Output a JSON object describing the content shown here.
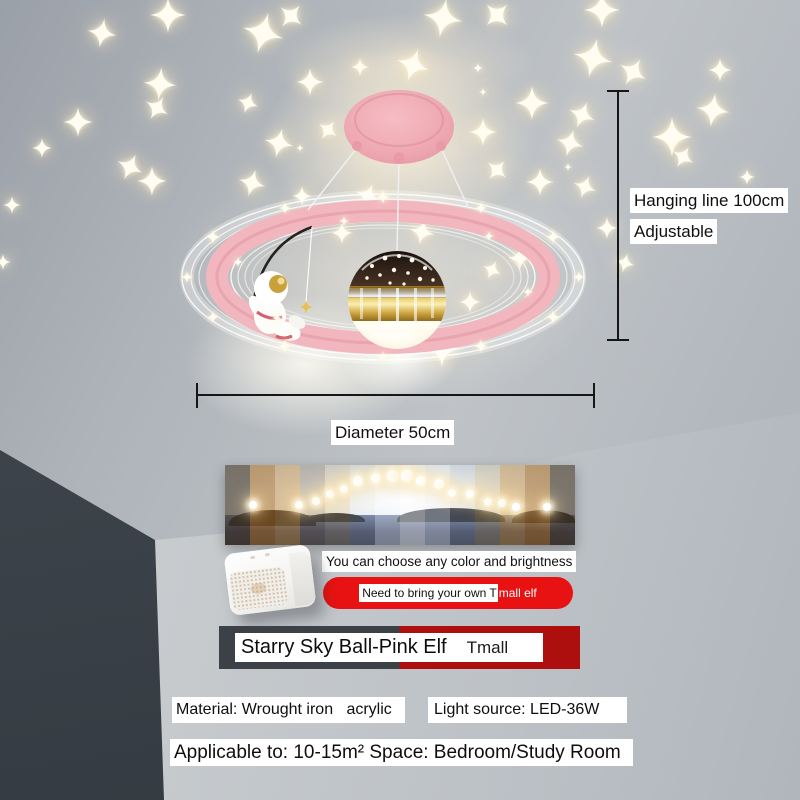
{
  "annotations": {
    "hanging_line": "Hanging line 100cm",
    "adjustable": "Adjustable",
    "diameter": "Diameter 50cm"
  },
  "banner": {
    "caption": "You can choose any color and brightness",
    "stripe_colors": [
      "rgba(80,62,38,0.60)",
      "rgba(186,115,28,0.52)",
      "rgba(224,158,62,0.44)",
      "rgba(160,130,88,0.34)",
      "rgba(232,196,128,0.28)",
      "rgba(242,238,228,0.22)",
      "rgba(250,252,255,0.40)",
      "rgba(255,255,255,0.50)",
      "rgba(250,252,255,0.40)",
      "rgba(238,236,228,0.22)",
      "rgba(234,198,126,0.30)",
      "rgba(224,158,62,0.44)",
      "rgba(186,115,28,0.52)",
      "rgba(80,62,38,0.60)"
    ],
    "islands": [
      [
        1,
        26,
        16,
        56
      ],
      [
        23,
        40,
        9,
        60
      ],
      [
        49,
        80,
        14,
        54
      ],
      [
        82,
        100,
        13,
        56
      ]
    ],
    "dots": [
      [
        8,
        50,
        4
      ],
      [
        21,
        50,
        4
      ],
      [
        26,
        45,
        4
      ],
      [
        30,
        36,
        4
      ],
      [
        34,
        30,
        4
      ],
      [
        38,
        20,
        5
      ],
      [
        43,
        16,
        5
      ],
      [
        48,
        14,
        6
      ],
      [
        52,
        14,
        6
      ],
      [
        56,
        20,
        5
      ],
      [
        61,
        24,
        5
      ],
      [
        65,
        35,
        4
      ],
      [
        70,
        36,
        4
      ],
      [
        75,
        46,
        4
      ],
      [
        79,
        48,
        4
      ],
      [
        83,
        53,
        4
      ],
      [
        92,
        52,
        4
      ]
    ]
  },
  "elf_note": {
    "black_part": "Need to bring your own T",
    "white_part": "mall elf"
  },
  "title": {
    "name": "Starry Sky Ball-Pink Elf",
    "brand": "Tmall"
  },
  "specs": {
    "material": "Material: Wrought iron   acrylic",
    "light_source": "Light source: LED-36W",
    "applicable": "Applicable to: 10-15m² Space: Bedroom/Study Room"
  },
  "colors": {
    "ring_pink": "#f2b6bf",
    "canopy_pink": "#eda6b0",
    "pill_red": "#e81212",
    "bar_red": "#ad0e0e",
    "bar_dark": "#3b4147",
    "gold": "#d9b54a"
  },
  "stars": {
    "ceiling": [
      [
        102,
        33,
        30,
        10
      ],
      [
        168,
        15,
        36,
        0
      ],
      [
        263,
        33,
        42,
        15
      ],
      [
        291,
        16,
        28,
        40
      ],
      [
        160,
        84,
        34,
        5
      ],
      [
        157,
        108,
        26,
        30
      ],
      [
        78,
        122,
        30,
        0
      ],
      [
        248,
        103,
        22,
        20
      ],
      [
        310,
        82,
        28,
        0
      ],
      [
        279,
        143,
        30,
        12
      ],
      [
        42,
        148,
        20,
        0
      ],
      [
        130,
        167,
        28,
        25
      ],
      [
        152,
        181,
        30,
        0
      ],
      [
        252,
        183,
        28,
        15
      ],
      [
        328,
        130,
        22,
        35
      ],
      [
        360,
        67,
        18,
        0
      ],
      [
        12,
        205,
        18,
        0
      ],
      [
        3,
        262,
        16,
        0
      ],
      [
        443,
        18,
        40,
        10
      ],
      [
        497,
        15,
        30,
        45
      ],
      [
        602,
        10,
        36,
        0
      ],
      [
        593,
        58,
        40,
        12
      ],
      [
        633,
        72,
        30,
        30
      ],
      [
        720,
        70,
        24,
        0
      ],
      [
        413,
        65,
        34,
        18
      ],
      [
        532,
        103,
        34,
        0
      ],
      [
        582,
        115,
        28,
        22
      ],
      [
        713,
        110,
        34,
        8
      ],
      [
        672,
        137,
        40,
        0
      ],
      [
        683,
        157,
        24,
        30
      ],
      [
        483,
        132,
        28,
        0
      ],
      [
        570,
        143,
        28,
        15
      ],
      [
        497,
        170,
        24,
        40
      ],
      [
        540,
        182,
        28,
        0
      ],
      [
        585,
        187,
        24,
        20
      ],
      [
        747,
        177,
        16,
        0
      ],
      [
        607,
        228,
        22,
        0
      ],
      [
        625,
        263,
        20,
        15
      ],
      [
        422,
        232,
        26,
        12
      ],
      [
        520,
        258,
        24,
        0
      ],
      [
        492,
        270,
        20,
        25
      ],
      [
        470,
        302,
        22,
        0
      ],
      [
        530,
        307,
        20,
        15
      ],
      [
        342,
        233,
        22,
        0
      ],
      [
        368,
        196,
        26,
        20
      ],
      [
        302,
        196,
        20,
        0
      ],
      [
        442,
        349,
        36,
        0
      ],
      [
        478,
        68,
        10,
        0
      ],
      [
        483,
        92,
        8,
        0
      ],
      [
        568,
        167,
        8,
        0
      ],
      [
        300,
        148,
        8,
        0
      ]
    ],
    "ring": [
      [
        579,
        277,
        12
      ],
      [
        553,
        317,
        14
      ],
      [
        481,
        346,
        14
      ],
      [
        383,
        357,
        12
      ],
      [
        285,
        346,
        14
      ],
      [
        213,
        317,
        12
      ],
      [
        187,
        277,
        12
      ],
      [
        213,
        237,
        14
      ],
      [
        285,
        208,
        12
      ],
      [
        383,
        197,
        14
      ],
      [
        481,
        208,
        12
      ],
      [
        553,
        237,
        14
      ],
      [
        528,
        292,
        10
      ],
      [
        422,
        333,
        10
      ],
      [
        277,
        318,
        10
      ],
      [
        238,
        262,
        10
      ],
      [
        344,
        221,
        10
      ],
      [
        489,
        236,
        10
      ]
    ]
  }
}
